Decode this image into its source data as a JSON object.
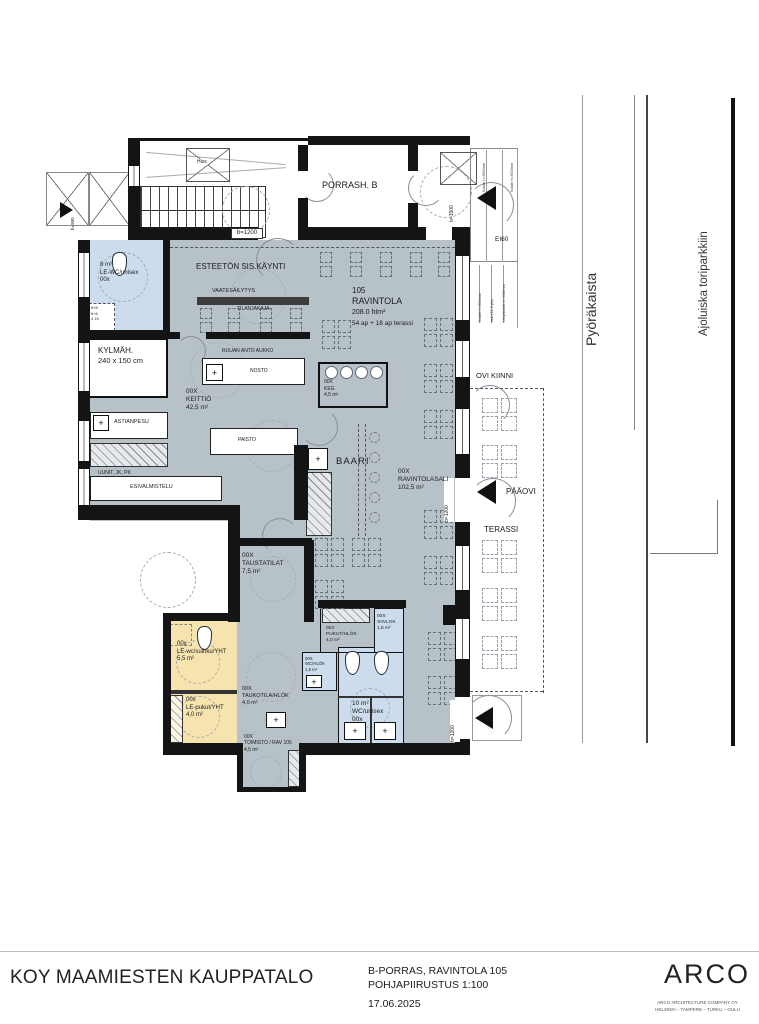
{
  "colors": {
    "floor": "#b7c1c8",
    "wet": "#ccdcec",
    "accent_yellow": "#f6e3ae",
    "wall": "#141414"
  },
  "site": {
    "street_left": "Pyöräkaista",
    "street_right": "Ajoluiska toriparkkiin"
  },
  "stair_block": {
    "porras": "PORRASH. B",
    "hiss": "Hiss"
  },
  "dims": {
    "b1200": "b=1200",
    "b1500": "b=1500",
    "b900": "b=900",
    "ei60": "EI60"
  },
  "notes": {
    "kaide": "Kaide h=900mm",
    "lasi": "lasi (11,5 pk)",
    "umpikaide": "Umpikaide h=900mm",
    "fixture1": "8+8",
    "fixture2": "6+6",
    "fixture3": "4 15"
  },
  "rooms": {
    "esteeton": {
      "name": "ESTEETÖN SIS.KÄYNTI"
    },
    "vaatesailytys": {
      "name": "VAATESÄILYTYS"
    },
    "tilanjakaja": {
      "name": "TILANJAKAJA"
    },
    "ravintola": {
      "number": "105",
      "name": "RAVINTOLA",
      "area": "208.0 htm²",
      "capacity": "54 ap + 18 ap terassi"
    },
    "le_wc": {
      "area": "8 m²",
      "name": "LE-WC/unisex",
      "number": "00x"
    },
    "kylmah": {
      "name": "KYLMÄH.",
      "size": "240 x 150 cm"
    },
    "keittio": {
      "number": "00X",
      "name": "KEITTIÖ",
      "area": "42,5 m²"
    },
    "ruuan_anto": {
      "name": "RUUAN ANTO AUKKO"
    },
    "nosto": {
      "name": "NOSTO"
    },
    "astianpesu": {
      "name": "ASTIANPESU"
    },
    "uunit": {
      "name": "UUNIT, JK, PK"
    },
    "esivalmistelu": {
      "name": "ESIVALMISTELU"
    },
    "paisto": {
      "name": "PAISTO"
    },
    "keg": {
      "number": "00X",
      "name": "KEG",
      "area": "4,5 m²"
    },
    "baari": {
      "name": "BAARI"
    },
    "ravintolasali": {
      "number": "00X",
      "name": "RAVINTOLASALI",
      "area": "102,5 m²"
    },
    "ovi_kiinni": {
      "name": "OVI KIINNI"
    },
    "paaovi": {
      "name": "PÄÄOVI"
    },
    "terassi": {
      "name": "TERASSI"
    },
    "taustatilat": {
      "number": "00X",
      "name": "TAUSTATILAT",
      "area": "7,5 m²"
    },
    "le_wc_suihku": {
      "number": "00x",
      "name": "LE-wc/suihku/YHT",
      "area": "5,5 m²"
    },
    "le_pukut": {
      "number": "00x",
      "name": "LE-pukut/YHT",
      "area": "4,0 m²"
    },
    "taukotila": {
      "number": "00X",
      "name": "TAUKOTILA/HLÖK",
      "area": "4,0 m²"
    },
    "toimisto": {
      "number": "00X",
      "name": "TOIMISTO / RAV 105",
      "area": "4,5 m²"
    },
    "pukut": {
      "number": "00X",
      "name": "PUKUT/HLÖK",
      "area": "4,0 m²"
    },
    "siivlok": {
      "number": "00X",
      "name": "SIIVLOK",
      "area": "1,5 m²"
    },
    "wc_hlok": {
      "number": "00X",
      "name": "WC/HLÖK",
      "area": "1,5 m²"
    },
    "wc_unisex": {
      "area": "10 m²",
      "name": "WC/unisex",
      "number": "00x"
    }
  },
  "title_block": {
    "project": "KOY MAAMIESTEN KAUPPATALO",
    "drawing_line1": "B-PORRAS, RAVINTOLA 105",
    "drawing_line2": "POHJAPIIRUSTUS 1:100",
    "date": "17.06.2025",
    "logo": "ARCO",
    "company_line1": "ARCO ARCHITECTURE COMPANY OY",
    "company_line2": "HELSINKI – TAMPERE – TURKU – OULU"
  }
}
